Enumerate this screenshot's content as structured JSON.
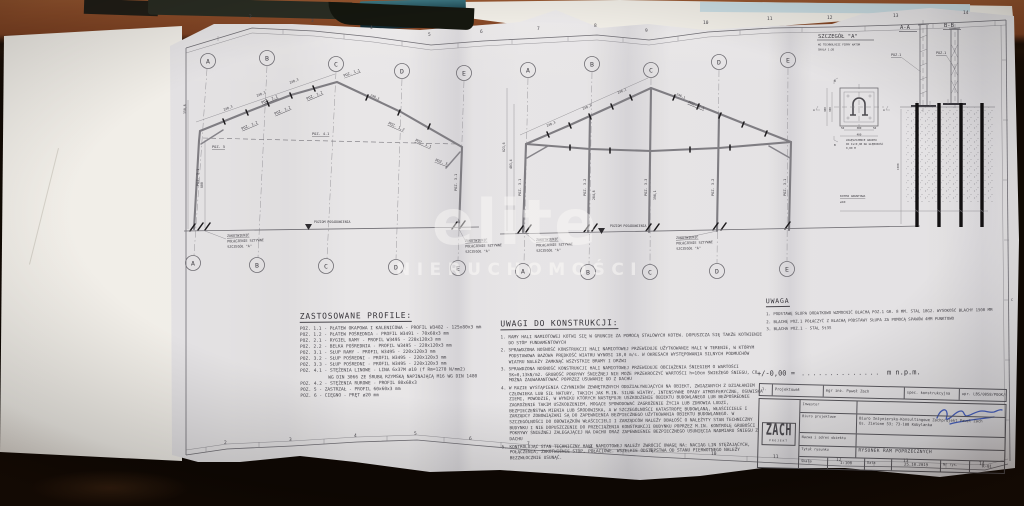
{
  "colors": {
    "signature_blue": "#3050c0",
    "paper": "#e7e7ea",
    "wood": "#8a4a28",
    "anchor_black": "#0d0d10"
  },
  "ruler": [
    "2",
    "3",
    "4",
    "5",
    "6",
    "7",
    "8",
    "9",
    "10",
    "11",
    "12",
    "13",
    "14"
  ],
  "grid": [
    "A",
    "B",
    "C",
    "D",
    "E"
  ],
  "edge_letter": "C",
  "watermark": {
    "line1": "elite",
    "line2": "NIERUCHOMOŚCI"
  },
  "frames": {
    "ground": "POZIOM POSADOWIENIA",
    "note1": "ZAKOTWIENIE",
    "note2": "POŁĄCZENIE SZTYWNE",
    "note3": "SZCZEGÓŁ \"A\""
  },
  "poz": {
    "p11": "POZ. 1.1",
    "p12": "POZ. 1.2",
    "p21": "POZ. 2.1",
    "p31": "POZ. 3.1",
    "p32": "POZ. 3.2",
    "p33": "POZ. 3.3",
    "p41": "POZ. 4.1",
    "p5": "POZ. 5"
  },
  "dim": {
    "d2483": "248,3",
    "d2461": "246,1",
    "d2848": "284,8",
    "d3981": "398,1",
    "d6236": "623,6",
    "d4034": "403,4",
    "d600": "600",
    "d3508": "350,8",
    "d1500": "1500",
    "d400": "400",
    "d300": "300",
    "d50": "50"
  },
  "detail": {
    "title": "SZCZEGÓŁ \"A\"",
    "sub1": "WG TECHNOLOGII FIRMY WATOM",
    "sub2": "SKALA 1:20",
    "sec_a": "A-A",
    "sec_b": "B-B",
    "poz1": "POZ.1",
    "ground1": "ZAGĘSZCZENIE GRUNTU",
    "ground2": "DO Is=0,98 NA GŁĘBOKOŚĆ",
    "ground3": "0,80 M",
    "kotew": "KOTEW GRUNTOWA",
    "kotew_dia": "ø40",
    "mark_a": "A",
    "mark_b": "B"
  },
  "profiles": {
    "title": "ZASTOSOWANE PROFILE:",
    "items": [
      "POZ. 1.1 - PŁATEW OKAPOWA I KALENICOWA - PROFIL W3482 - 125x80x3 mm",
      "POZ. 1.2 - PŁATEW POŚREDNIA - PROFIL W3491 - 70x60x3 mm",
      "POZ. 2.1 - RYGIEL RAMY - PROFIL W3495 - 220x120x3 mm",
      "POZ. 2.2 - BELKA POŚREDNIA - PROFIL W3495 - 220x120x3 mm",
      "POZ. 3.1 - SŁUP RAMY - PROFIL W3495 - 220x120x3 mm",
      "POZ. 3.2 - SŁUP POŚREDNI - PROFIL W3495 - 220x120x3 mm",
      "POZ. 3.3 - SŁUP POŚREDNI - PROFIL W3495 - 220x120x3 mm",
      "POZ. 4.1 - STĘŻENIA LINOWE - LINA 6x37M ø10 (f Rm=1270 N/mm2)",
      "WG DIN 3066 ZE ŚRUBĄ RZYMSKĄ NAPINAJĄCĄ M16 WG DIN 1480",
      "POZ. 4.2 - STĘŻENIA RUROWE - PROFIL 80x60x3",
      "POZ. 5 - ZASTRZAŁ - PROFIL 60x60x3 mm",
      "POZ. 6 - CIĘGNO - PRĘT ø20 mm"
    ]
  },
  "notes": {
    "title": "UWAGI DO KONSTRUKCJI:",
    "items": [
      "1. RAMY HALI NAMIOTOWEJ KOTWI SIĘ W GRUNCIE ZA POMOCĄ STALOWYCH KOTEW. DOPUSZCZA SIĘ TAKŻE KOTWIENIE DO STÓP FUNDAMENTOWYCH",
      "2. SPRAWDZONA NOŚNOŚĆ KONSTRUKCJI HALI NAMIOTOWEJ PRZEWIDUJE UŻYTKOWANIE HALI W TERENIE, W KTÓRYM PODSTAWOWA BAZOWA PRĘDKOŚĆ WIATRU WYNOSI 18,0 m/s. W OKRESACH WYSTĘPOWANIA SILNYCH PODMUCHÓW WIATRU NALEŻY ZAMKNĄĆ WSZYSTKIE BRAMY I DRZWI",
      "3. SPRAWDZONA NOŚNOŚĆ KONSTRUKCJI HALI NAMIOTOWEJ PRZEWIDUJE OBCIĄŻENIA ŚNIEGIEM O WARTOŚCI SK=0,13kN/m2. GRUBOŚĆ POKRYWY ŚNIEŻNEJ NIE MOŻE PRZEKROCZYĆ WARTOŚCI h=10cm ŚWIEŻEGO ŚNIEGU, CO MOŻNA ZAGWARANTOWAĆ POPRZEZ USUWANIE GO Z DACHU",
      "4. W RAZIE WYSTĄPIENIA CZYNNIKÓW ZEWNĘTRZNYCH ODDZIAŁYWUJĄCYCH NA OBIEKT, ZWIĄZANYCH Z DZIAŁANIEM CZŁOWIEKA LUB SIŁ NATURY, TAKICH JAK M.IN. SILNE WIATRY, INTENSYWNE OPADY ATMOSFERYCZNE, OSUWISKA ZIEMI, POWODZIE, W WYNIKU KTÓRYCH NASTĘPUJE USZKODZENIE OBIEKTU BUDOWLANEGO LUB BEZPOŚREDNIE ZAGROŻENIE TAKIM USZKODZENIEM, MOGĄCE SPOWODOWAĆ ZAGROŻENIE ŻYCIA LUB ZDROWIA LUDZI, BEZPIECZEŃSTWA MIENIA LUB ŚRODOWISKA, A W SZCZEGÓLNOŚCI KATASTROFĘ BUDOWLANĄ, WŁAŚCICIELE I ZARZĄDCY ZOBOWIĄZANI SĄ DO ZAPEWNIENIA BEZPIECZNEGO UŻYTKOWANIA OBIEKTU BUDOWLANEGO. W SZCZEGÓLNOŚCI DO OBOWIĄZKÓW WŁAŚCICIELI I ZARZĄDCÓW NALEŻY DBAŁOŚĆ O NALEŻYTY STAN TECHNICZNY BUDYNKU I NIE DOPUSZCZENIE DO PRZECIĄŻENIA KONSTRUKCJI BUDYNKU POPRZEZ M.IN. KONTROLĘ GRUBOŚCI POKRYWY ŚNIEŻNEJ ZALEGAJĄCEJ NA DACHU ORAZ ZAPEWNIENIE BEZPIECZNEGO USUNIĘCIA NADMIARU ŚNIEGU Z DACHU",
      "5. KONTROLUJĄC STAN TECHNICZNY HALI NAMIOTOWEJ NALEŻY ZWRÓCIĆ UWAGĘ NA: NACIĄG LIN STĘŻAJĄCYCH, POŁĄCZENIA, ZAKOTWIENIE STÓP, POŁACIOWE. WSZELKIE ODSTĘPSTWA OD STANU PIERWOTNEGO NALEŻY BEZZWŁOCZNIE USUNĄĆ."
    ]
  },
  "uwaga": {
    "title": "UWAGA",
    "items": [
      "1. PODSTAWĘ SŁUPA DODATKOWO WZMOCNIĆ BLACHĄ POZ.1 GR. 8 MM. STAL 18G2. WYSOKOŚĆ BLACHY 1500 MM",
      "2. BLACHĘ POZ.1 POŁĄCZYĆ Z BLACHĄ PODSTAWY SŁUPA ZA POMOCĄ SPAWÓW 4MM PUNKTOWO",
      "3. BLACHA POZ.1 - STAL St3S"
    ]
  },
  "elevation": {
    "prefix": "+/-0,00 =",
    "dots": "..............",
    "suffix": "m n.p.m."
  },
  "title_block": {
    "row1_no": "1.",
    "row1_label": "Projektował",
    "row1_name": "mgr inż. Paweł Zach",
    "row1_spec": "spec. konstrukcyjna",
    "row1_upr": "upr. LBS/0058/POOK/07",
    "logo_main": "ZACH",
    "logo_sub": "PROJEKT",
    "inwestor_label": "Inwestor",
    "biuro_label": "Biuro projektowe",
    "biuro_value1": "Biuro Inżyniersko-Konsultingowe Zachprojekt Paweł Zach",
    "biuro_value2": "Os. Zielone 53; 73-108 Kobylanka",
    "nazwa_label": "Nazwa i adres obiektu",
    "tytul_label": "Tytuł rysunku",
    "tytul_value": "RYSUNEK RAM POPRZECZNYCH",
    "skala_label": "Skala",
    "skala_value": "1:100",
    "data_label": "Data",
    "data_value": "25.10.2019",
    "nr_label": "Nr rys.",
    "nr_value": "K-01"
  }
}
